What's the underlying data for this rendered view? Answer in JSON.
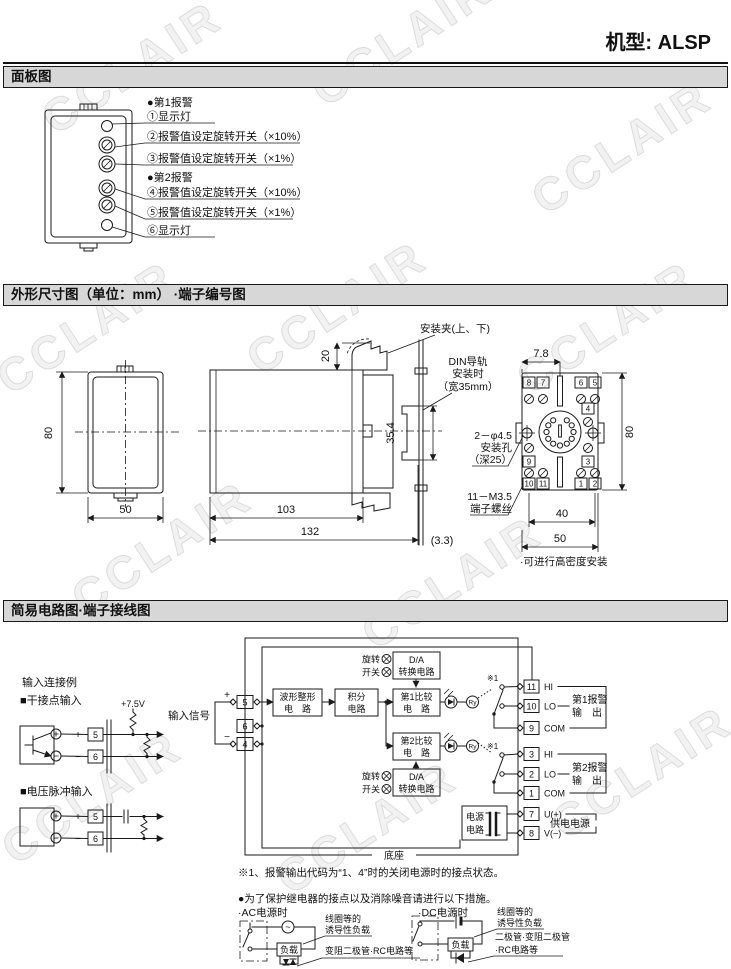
{
  "header": {
    "model": "机型: ALSP"
  },
  "watermark": "CCLAIR",
  "panel": {
    "title": "面板图",
    "alarm1": "●第1报警",
    "alarm2": "●第2报警",
    "items": {
      "i1": "①显示灯",
      "i2": "②报警值设定旋转开关（×10%）",
      "i3": "③报警值设定旋转开关（×1%）",
      "i4": "④报警值设定旋转开关（×10%）",
      "i5": "⑤报警值设定旋转开关（×1%）",
      "i6": "⑥显示灯"
    }
  },
  "dims": {
    "title": "外形尺寸图（单位：mm） ·端子编号图",
    "front": {
      "h": "80",
      "w": "50"
    },
    "side": {
      "clip": "安装夹(上、下)",
      "din_l1": "DIN导轨",
      "din_l2": "安装时",
      "din_l3": "（宽35mm）",
      "d20": "20",
      "d354": "35.4",
      "d103": "103",
      "d132": "132",
      "d33": "(3.3)"
    },
    "socket": {
      "d78": "7.8",
      "d80": "80",
      "d40": "40",
      "d50": "50",
      "hole_l1": "2－φ4.5",
      "hole_l2": "安装孔",
      "hole_l3": "（深25）",
      "screw_l1": "11－M3.5",
      "screw_l2": "端子螺丝",
      "note": "·可进行高密度安装",
      "t": {
        "n8": "8",
        "n7": "7",
        "n6": "6",
        "n5": "5",
        "n4": "4",
        "n9": "9",
        "n3": "3",
        "n10": "10",
        "n11": "11",
        "n1": "1",
        "n2": "2"
      }
    }
  },
  "circuit": {
    "title": "简易电路图·端子接线图",
    "examples": {
      "header": "输入连接例",
      "dry": "■干接点输入",
      "pulse": "■电压脉冲输入",
      "v75": "+7.5V",
      "signal": "输入信号",
      "plus": "+",
      "minus": "−",
      "t5": "5",
      "t6": "6"
    },
    "blocks": {
      "wave1": "波形整形",
      "wave2": "电　路",
      "integ1": "积分",
      "integ2": "电路",
      "comp1a": "第1比较",
      "comp2a": "第2比较",
      "compb": "电　路",
      "da1": "D/A",
      "da2": "转换电路",
      "rot1": "旋转",
      "rot2": "开关",
      "ps1": "电源",
      "ps2": "电路",
      "ry": "Ry",
      "base": "底座",
      "ref": "※1"
    },
    "left_terminals": [
      "5",
      "6",
      "4"
    ],
    "right_terminals": [
      {
        "num": "11",
        "label": "HI"
      },
      {
        "num": "10",
        "label": "LO"
      },
      {
        "num": "9",
        "label": "COM"
      },
      {
        "num": "3",
        "label": "HI"
      },
      {
        "num": "2",
        "label": "LO"
      },
      {
        "num": "1",
        "label": "COM"
      },
      {
        "num": "7",
        "label": "U(+)"
      },
      {
        "num": "8",
        "label": "V(−)"
      }
    ],
    "groups": {
      "a1l1": "第1报警",
      "a2l1": "第2报警",
      "out": "输　出",
      "power": "供电电源"
    },
    "notes": {
      "n1": "※1、报警输出代码为“1、4”时的关闭电源时的接点状态。",
      "n2": "●为了保护继电器的接点以及消除噪音请进行以下措施。",
      "ac": "·AC电源时",
      "dc": "·DC电源时",
      "load": "负载",
      "coil1": "线圈等的",
      "coil2": "诱导性负载",
      "ac_snub": "变阻二极管·RC电路等",
      "dc_snub1": "二极管·变阻二极管",
      "dc_snub2": "·RC电路等"
    }
  }
}
